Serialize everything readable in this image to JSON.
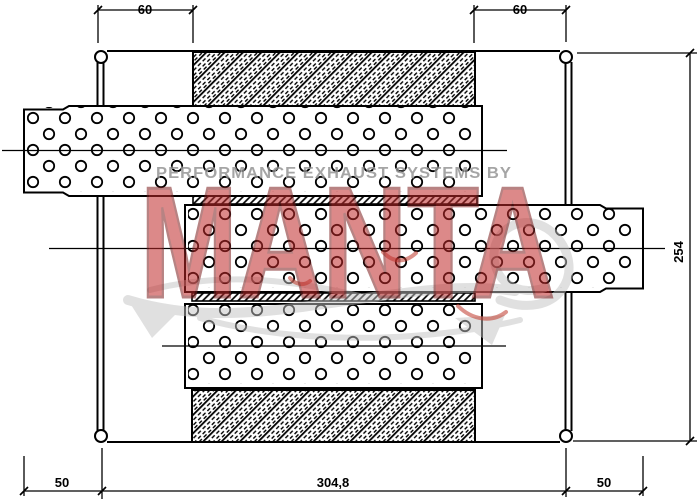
{
  "drawing": {
    "title": "muffler-technical-drawing",
    "dimensions": {
      "top_left": "60",
      "top_right": "60",
      "bottom_left": "50",
      "bottom_center": "304,8",
      "bottom_right": "50",
      "right_vertical": "254"
    },
    "watermark": {
      "tagline": "PERFORMANCE EXHAUST SYSTEMS BY",
      "brand": "MANTA",
      "brand_fill": "#c02a2a",
      "brand_outline": "#7d1f1f",
      "tagline_color": "#8f8f8f",
      "swoosh_color": "#c2c2c2"
    },
    "line_color": "#000000",
    "background": "#ffffff"
  }
}
